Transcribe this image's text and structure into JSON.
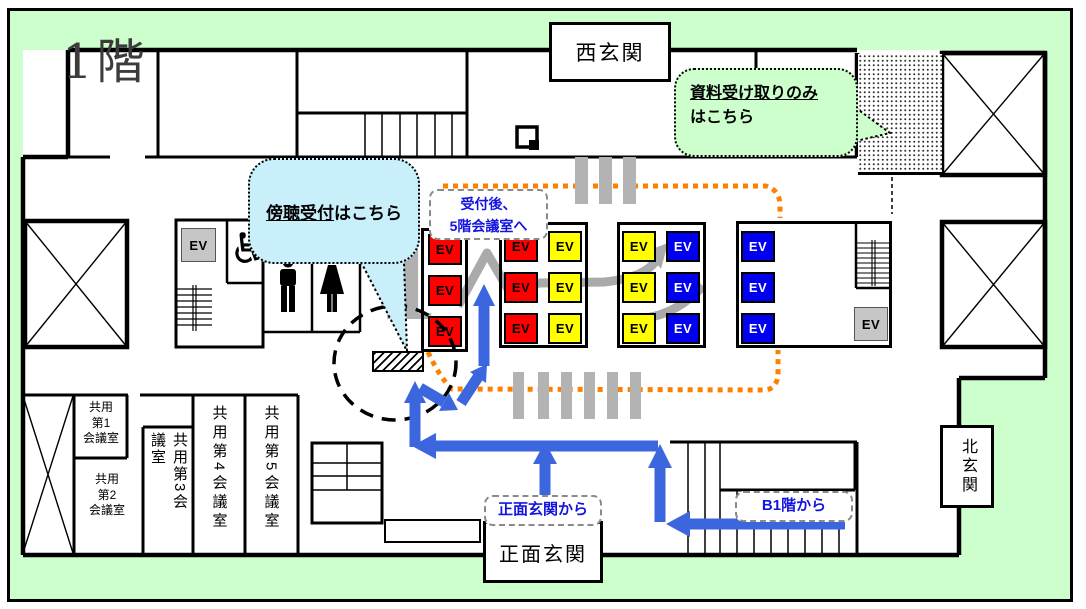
{
  "floor": {
    "label": "1階",
    "big_numeral": "1"
  },
  "labels": {
    "ev": "EV"
  },
  "entrances": {
    "west": "西玄関",
    "north": "北玄関",
    "main": "正面玄関"
  },
  "callouts": {
    "green_bubble": {
      "underlined": "資料受け取りのみ",
      "line2": "はこちら"
    },
    "blue_bubble": {
      "underlined": "傍聴受付",
      "suffix": "はこちら"
    },
    "after_reception": {
      "line1": "受付後、",
      "line2": "5階会議室へ"
    },
    "from_main_entrance": "正面玄関から",
    "from_b1": "B1階から"
  },
  "rooms": {
    "room1": {
      "line1": "共用",
      "line2": "第1",
      "line3": "会議室"
    },
    "room2": {
      "line1": "共用",
      "line2": "第2",
      "line3": "会議室"
    },
    "room3": "共用第3会議室",
    "room4": "共用第4会議室",
    "room5": "共用第5会議室"
  },
  "colors": {
    "page_background": "#CCFFCC",
    "blue_bubble_fill": "#C9EFFA",
    "green_bubble_fill": "#CCFFCC",
    "ev_red": "#FF0000",
    "ev_yellow": "#FFFF00",
    "ev_blue": "#0000EE",
    "ev_gray": "#C6C6C6",
    "route_blue": "#3B66DD",
    "route_orange": "#FF8000"
  }
}
